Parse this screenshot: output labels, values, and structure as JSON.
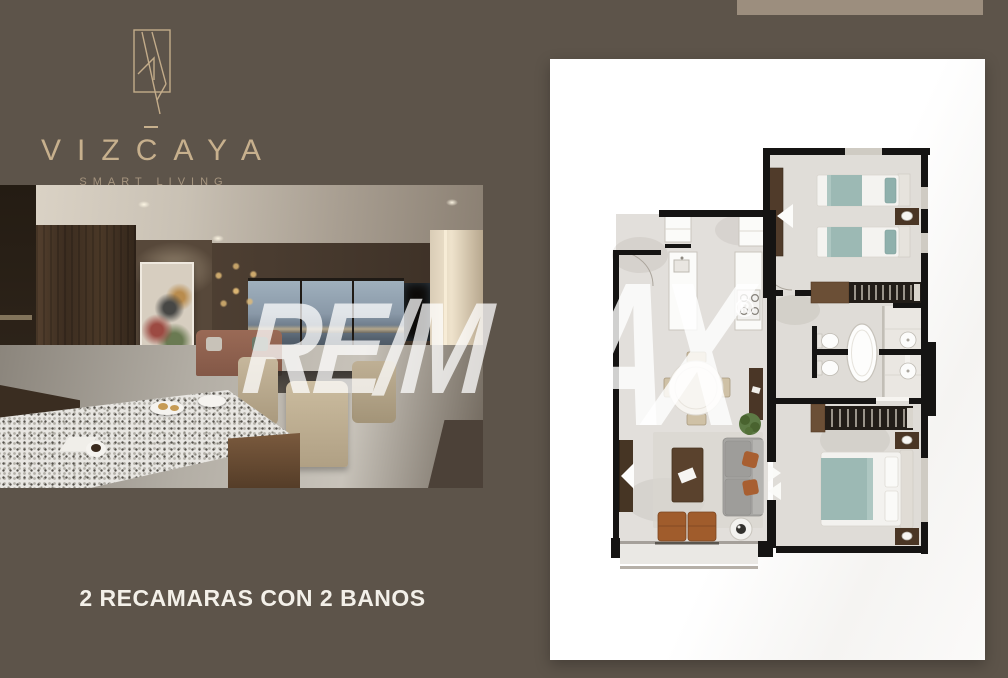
{
  "branding": {
    "logo_text": "VIZCAYA",
    "tagline": "SMART LIVING"
  },
  "caption": {
    "text": "2 RECAMARAS CON 2 BANOS"
  },
  "watermark": {
    "brand": "RE/MAX",
    "segment_left": "RE/M",
    "segment_right": "AX",
    "registered_symbol": "®"
  },
  "colors": {
    "background": "#5d544a",
    "accent_bar": "#9c8e7e",
    "logo_gold": "#c7b08d",
    "tagline_gold": "#a6957f",
    "caption_text": "#f3f0e9",
    "panel_white": "#ffffff",
    "plan_wall": "#151413",
    "plan_floor": "#e1ded9",
    "bed_teal": "#9cb9b4",
    "wood_brown": "#6b4f36",
    "accent_chair_brown": "#a05c2c",
    "watermark_white": "rgba(255,255,255,0.75)"
  }
}
